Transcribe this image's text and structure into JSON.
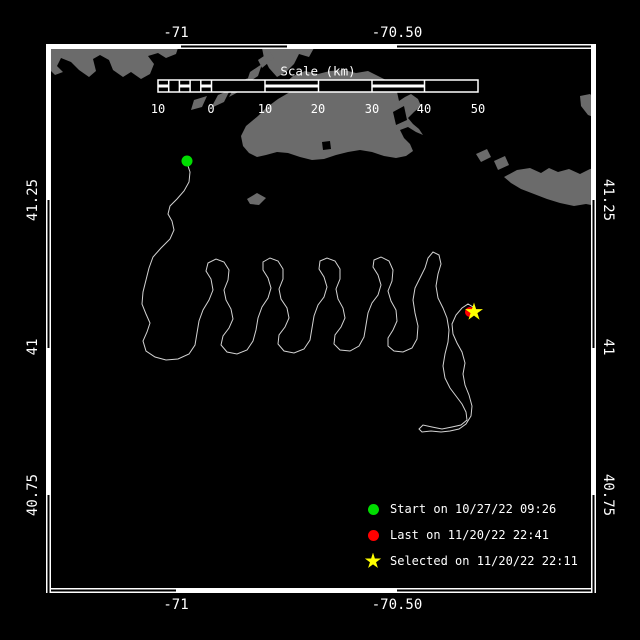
{
  "colors": {
    "background": "#000000",
    "land": "#6b6b6b",
    "track": "#d3d3d3",
    "frame": "#ffffff",
    "text": "#ffffff",
    "start_green": "#00dd00",
    "last_red": "#ff0000",
    "selected_yellow": "#ffff00"
  },
  "axis_labels": [
    {
      "name": "top-lon-label-1",
      "label": "-71",
      "x": 176,
      "y": 33,
      "rot": 0
    },
    {
      "name": "top-lon-label-2",
      "label": "-70.50",
      "x": 397,
      "y": 33,
      "rot": 0
    },
    {
      "name": "bottom-lon-label-1",
      "label": "-71",
      "x": 176,
      "y": 605,
      "rot": 0
    },
    {
      "name": "bottom-lon-label-2",
      "label": "-70.50",
      "x": 397,
      "y": 605,
      "rot": 0
    },
    {
      "name": "left-lat-label-1",
      "label": "41.25",
      "x": 33,
      "y": 200,
      "rot": -90
    },
    {
      "name": "left-lat-label-2",
      "label": "41",
      "x": 33,
      "y": 347,
      "rot": -90
    },
    {
      "name": "left-lat-label-3",
      "label": "40.75",
      "x": 33,
      "y": 495,
      "rot": -90
    },
    {
      "name": "right-lat-label-1",
      "label": "41.25",
      "x": 608,
      "y": 200,
      "rot": 90
    },
    {
      "name": "right-lat-label-2",
      "label": "41",
      "x": 608,
      "y": 347,
      "rot": 90
    },
    {
      "name": "right-lat-label-3",
      "label": "40.75",
      "x": 608,
      "y": 495,
      "rot": 90
    }
  ],
  "frame": {
    "interior": [
      51,
      49,
      540,
      539
    ],
    "sides": [
      {
        "name": "frame-top",
        "band": [
          46,
          44,
          550,
          5
        ],
        "dir": "h",
        "hollow": [
          [
            181,
            287
          ],
          [
            397,
            596
          ]
        ]
      },
      {
        "name": "frame-bottom",
        "band": [
          46,
          588,
          550,
          5
        ],
        "dir": "h",
        "hollow": [
          [
            46,
            176
          ],
          [
            397,
            596
          ]
        ]
      },
      {
        "name": "frame-left",
        "band": [
          46,
          44,
          5,
          549
        ],
        "dir": "v",
        "hollow": [
          [
            200,
            348
          ],
          [
            495,
            593
          ]
        ]
      },
      {
        "name": "frame-right",
        "band": [
          591,
          44,
          5,
          549
        ],
        "dir": "v",
        "hollow": [
          [
            200,
            348
          ],
          [
            495,
            593
          ]
        ]
      }
    ]
  },
  "scalebar": {
    "title": "Scale (km)",
    "title_x": 318,
    "title_y": 71,
    "bar": {
      "x": 158,
      "y": 80,
      "w": 320,
      "h": 12
    },
    "separators": [
      168.7,
      179.4,
      190.1,
      200.8,
      211.5,
      265,
      318.5,
      372,
      424.5
    ],
    "striped": [
      [
        158,
        168.7
      ],
      [
        179.4,
        190.1
      ],
      [
        200.8,
        211.5
      ],
      [
        265,
        318.5
      ],
      [
        372,
        424.5
      ]
    ],
    "labels": [
      {
        "t": "10",
        "x": 158
      },
      {
        "t": "0",
        "x": 211
      },
      {
        "t": "10",
        "x": 265
      },
      {
        "t": "20",
        "x": 318
      },
      {
        "t": "30",
        "x": 372
      },
      {
        "t": "40",
        "x": 424
      },
      {
        "t": "50",
        "x": 478
      }
    ],
    "label_y": 109
  },
  "map_data": {
    "land": [
      {
        "name": "land-mainland-west",
        "points": "46,48 178,48 176,54 166,58 158,53 148,56 154,64 150,74 141,79 131,72 123,77 113,70 109,60 100,55 93,59 96,71 89,77 79,70 71,62 61,58 57,66 63,72 55,75 46,66"
      },
      {
        "name": "land-falmouth",
        "points": "262,48 314,48 309,57 299,54 294,64 286,72 277,77 269,68 264,58"
      },
      {
        "name": "land-elizabeth-1",
        "points": "258,60 270,52 274,58 262,68"
      },
      {
        "name": "land-elizabeth-2",
        "points": "250,72 262,64 258,76 246,84"
      },
      {
        "name": "land-elizabeth-3",
        "points": "236,84 248,78 242,90 229,97"
      },
      {
        "name": "land-elizabeth-4",
        "points": "218,95 230,90 224,102 211,108"
      },
      {
        "name": "land-cuttyhunk",
        "points": "194,100 207,96 202,107 191,110"
      },
      {
        "name": "land-marthas-vineyard",
        "points": "246,126 258,116 266,108 278,99 290,92 284,84 293,76 305,71 318,74 330,71 344,70 356,73 368,71 380,77 390,82 397,92 399,101 405,97 411,94 418,99 421,106 414,112 408,118 413,124 419,129 423,135 416,132 408,127 400,130 404,138 410,144 413,151 406,156 396,158 384,156 372,152 360,150 348,152 336,155 324,159 312,160 300,157 288,153 277,152 266,155 257,157 249,153 243,146 241,136"
      },
      {
        "name": "land-muskeget",
        "points": "476,154 487,149 491,157 481,162"
      },
      {
        "name": "land-tuckernuck",
        "points": "494,161 505,156 509,165 498,170"
      },
      {
        "name": "land-nantucket",
        "points": "504,177 517,170 530,168 541,173 549,168 558,172 569,169 580,174 590,169 596,168 596,206 586,204 574,206 560,203 547,199 534,194 521,189 511,183"
      },
      {
        "name": "land-no-mans-land",
        "points": "247,199 257,193 266,198 259,205 250,204"
      },
      {
        "name": "land-monomoy",
        "points": "580,96 590,94 596,100 596,118 588,115 581,106"
      }
    ],
    "water_notches": [
      {
        "name": "water-notch-pond",
        "points": "322,142 330,141 331,149 323,150"
      },
      {
        "name": "water-notch-bay",
        "points": "393,112 404,106 407,120 396,125"
      }
    ],
    "track": {
      "name": "track-line",
      "points": "187,163 190,172 189,182 184,191 177,199 170,206 168,214 172,221 174,230 170,239 161,248 153,257 149,268 146,280 143,292 142,304 146,314 150,323 147,332 143,341 146,351 155,357 166,360 178,359 189,354 195,345 197,333 199,321 203,310 209,300 213,290 211,279 206,271 208,263 216,259 224,262 229,270 228,280 224,290 226,300 231,309 233,319 229,328 223,336 221,345 227,352 237,354 247,350 253,341 256,330 258,318 262,307 268,298 271,288 268,278 263,270 263,262 270,258 278,261 283,269 283,279 279,289 281,299 287,308 289,318 285,327 279,335 278,344 284,351 294,353 304,349 310,340 312,328 314,316 318,305 324,297 327,287 324,277 319,269 320,261 327,258 335,261 340,269 340,279 336,289 338,299 343,308 345,318 341,327 335,335 334,344 340,350 350,351 359,346 364,337 366,325 368,313 372,303 378,295 381,285 378,275 373,267 374,260 381,257 389,261 393,270 392,281 388,291 391,301 396,310 397,321 393,330 388,338 388,346 394,351 403,352 412,348 417,339 418,326 415,313 413,300 415,288 420,278 425,268 428,258 433,252 439,255 441,264 438,274 436,286 438,298 443,308 447,318 449,330 448,342 445,354 443,366 445,378 450,388 456,396 462,404 466,412 467,420 461,425 452,427 442,429 432,427 423,425 419,429 422,432 431,431 441,432 450,431 459,429 466,424 471,416 472,406 469,395 465,385 463,374 465,363 462,352 457,343 453,334 452,324 456,315 462,308 468,304 473,307 474,311"
    },
    "star_points": "0,-9.5 2.1,-2.9 9,-2.9 3.4,1.1 5.6,7.7 0,3.6 -5.6,7.7 -3.4,1.1 -9,-2.9 -2.1,-2.9",
    "markers": [
      {
        "name": "start-marker",
        "type": "circle",
        "x": 187,
        "y": 161,
        "r": 5.5,
        "color": "#00dd00"
      },
      {
        "name": "last-marker",
        "type": "circle",
        "x": 470,
        "y": 312,
        "r": 5,
        "color": "#ff0000"
      },
      {
        "name": "selected-marker",
        "type": "star",
        "x": 474,
        "y": 312,
        "color": "#ffff00"
      }
    ]
  },
  "legend": {
    "marker_x": 364,
    "rows": [
      {
        "name": "legend-start",
        "y": 509,
        "shape": "circle",
        "color": "#00dd00",
        "label": "Start on 10/27/22 09:26"
      },
      {
        "name": "legend-last",
        "y": 535,
        "shape": "circle",
        "color": "#ff0000",
        "label": "Last on 11/20/22 22:41"
      },
      {
        "name": "legend-selected",
        "y": 561,
        "shape": "star",
        "color": "#ffff00",
        "label": "Selected on 11/20/22 22:11"
      }
    ]
  }
}
